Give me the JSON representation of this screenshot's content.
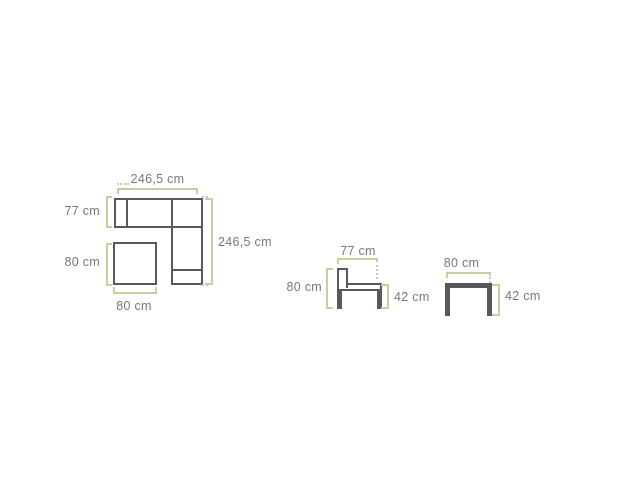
{
  "colors": {
    "background": "#ffffff",
    "dimension_line": "#c1d29d",
    "dotted_guide": "#c6c8c4",
    "furniture_outline": "#58595b",
    "label_text": "#77787a"
  },
  "diagrams": {
    "corner_sofa": {
      "dimensions": {
        "top_width": "246,5 cm",
        "left_depth": "77 cm",
        "right_length": "246,5 cm",
        "table_height": "80 cm",
        "table_width": "80 cm"
      }
    },
    "chair": {
      "dimensions": {
        "width": "77 cm",
        "height": "80 cm",
        "seat_height": "42 cm"
      }
    },
    "side_table": {
      "dimensions": {
        "width": "80 cm",
        "height": "42 cm"
      }
    }
  }
}
